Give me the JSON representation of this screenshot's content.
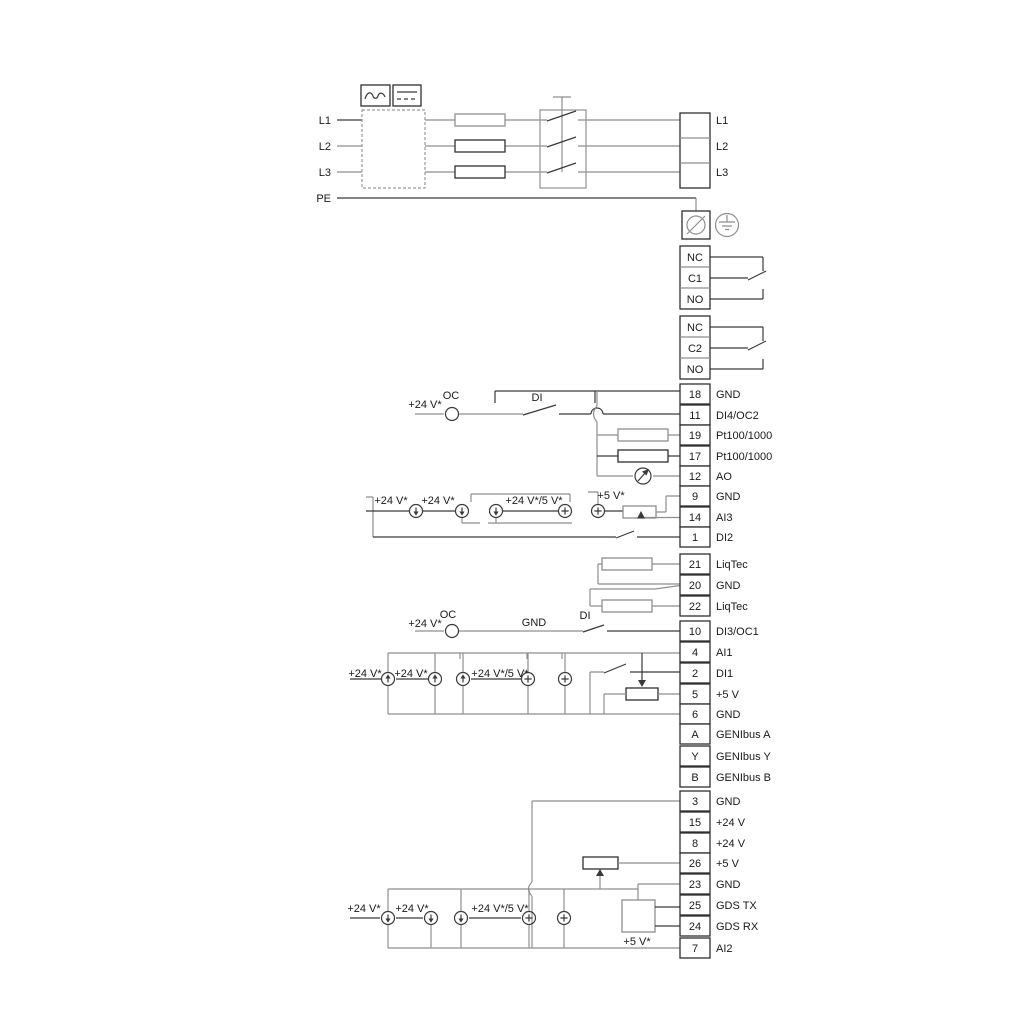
{
  "power_input": {
    "labels": [
      "L1",
      "L2",
      "L3",
      "PE"
    ]
  },
  "power_output": {
    "labels": [
      "L1",
      "L2",
      "L3"
    ]
  },
  "relays": [
    {
      "terminals": [
        "NC",
        "C1",
        "NO"
      ]
    },
    {
      "terminals": [
        "NC",
        "C2",
        "NO"
      ]
    }
  ],
  "terminals": [
    {
      "pin": "18",
      "label": "GND"
    },
    {
      "pin": "11",
      "label": "DI4/OC2"
    },
    {
      "pin": "19",
      "label": "Pt100/1000"
    },
    {
      "pin": "17",
      "label": "Pt100/1000"
    },
    {
      "pin": "12",
      "label": "AO"
    },
    {
      "pin": "9",
      "label": "GND"
    },
    {
      "pin": "14",
      "label": "AI3"
    },
    {
      "pin": "1",
      "label": "DI2"
    },
    {
      "pin": "21",
      "label": "LiqTec"
    },
    {
      "pin": "20",
      "label": "GND"
    },
    {
      "pin": "22",
      "label": "LiqTec"
    },
    {
      "pin": "10",
      "label": "DI3/OC1"
    },
    {
      "pin": "4",
      "label": "AI1"
    },
    {
      "pin": "2",
      "label": "DI1"
    },
    {
      "pin": "5",
      "label": "+5 V"
    },
    {
      "pin": "6",
      "label": "GND"
    },
    {
      "pin": "A",
      "label": "GENIbus A"
    },
    {
      "pin": "Y",
      "label": "GENIbus Y"
    },
    {
      "pin": "B",
      "label": "GENIbus B"
    },
    {
      "pin": "3",
      "label": "GND"
    },
    {
      "pin": "15",
      "label": "+24 V"
    },
    {
      "pin": "8",
      "label": "+24 V"
    },
    {
      "pin": "26",
      "label": "+5 V"
    },
    {
      "pin": "23",
      "label": "GND"
    },
    {
      "pin": "25",
      "label": "GDS TX"
    },
    {
      "pin": "24",
      "label": "GDS RX"
    },
    {
      "pin": "7",
      "label": "AI2"
    }
  ],
  "annotations": [
    {
      "id": "a-supply",
      "text": "+24 V*"
    },
    {
      "id": "a-oc",
      "text": "OC"
    },
    {
      "id": "a-di",
      "text": "DI"
    },
    {
      "id": "b-supply1",
      "text": "+24 V*"
    },
    {
      "id": "b-supply2",
      "text": "+24 V*"
    },
    {
      "id": "b-supply3",
      "text": "+24 V*/5 V*"
    },
    {
      "id": "b-5v",
      "text": "+5 V*"
    },
    {
      "id": "d-supply",
      "text": "+24 V*"
    },
    {
      "id": "d-oc",
      "text": "OC"
    },
    {
      "id": "d-gnd",
      "text": "GND"
    },
    {
      "id": "d-di",
      "text": "DI"
    },
    {
      "id": "e-supply1",
      "text": "+24 V*"
    },
    {
      "id": "e-supply2",
      "text": "+24 V*"
    },
    {
      "id": "e-supply3",
      "text": "+24 V*/5 V*"
    },
    {
      "id": "g-supply1",
      "text": "+24 V*"
    },
    {
      "id": "g-supply2",
      "text": "+24 V*"
    },
    {
      "id": "g-supply3",
      "text": "+24 V*/5 V*"
    },
    {
      "id": "g-5v",
      "text": "+5 V*"
    }
  ],
  "colors": {
    "wire_grey": "#8f8f8f",
    "wire_dark": "#3a3a3a",
    "text": "#1a1a1a"
  }
}
